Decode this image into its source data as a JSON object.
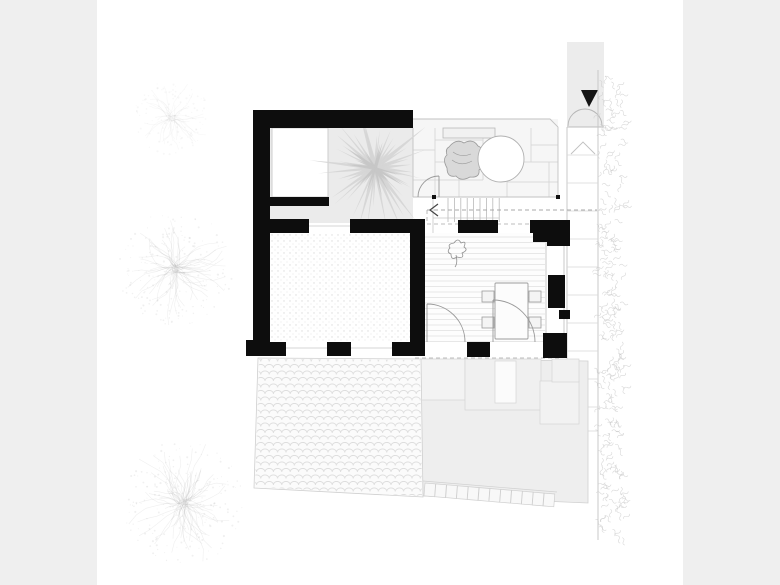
{
  "page": {
    "background": "#efefef",
    "canvas": "#ffffff"
  },
  "colors": {
    "wall": "#0d0d0d",
    "entry_arrow": "#141414",
    "courtyard": "#ebebeb",
    "terrace": "#f6f6f6",
    "path_band": "#ececec",
    "garden": "#eeeeee",
    "palm": "#d5d5d5",
    "palm_inner": "#c6c6c6",
    "tree": "#b4b4b4",
    "hedge": "#c9c9c9",
    "thin_line": "#c2c2c2",
    "tile_line": "#d2d2d2",
    "dash_line": "#a8a8a8",
    "furniture_line": "#9c9c9c"
  },
  "plan": {
    "type": "architectural-ground-floor-plan",
    "features": [
      {
        "name": "palm-tree-starburst"
      },
      {
        "name": "courtyard"
      },
      {
        "name": "terrace-tiles"
      },
      {
        "name": "bench"
      },
      {
        "name": "armchair"
      },
      {
        "name": "round-table"
      },
      {
        "name": "staircase",
        "treads": 9
      },
      {
        "name": "walk-line-arrow"
      },
      {
        "name": "dining-table"
      },
      {
        "name": "dining-chairs",
        "count": 4
      },
      {
        "name": "plant-sketch"
      },
      {
        "name": "door-swings",
        "count": 5
      },
      {
        "name": "scallop-paving"
      },
      {
        "name": "rear-garden"
      },
      {
        "name": "tile-strip",
        "tiles": 12
      },
      {
        "name": "entry-path"
      },
      {
        "name": "entry-arrow"
      },
      {
        "name": "gate-swing"
      },
      {
        "name": "hedge-band"
      },
      {
        "name": "sketch-trees",
        "count": 3
      }
    ]
  }
}
